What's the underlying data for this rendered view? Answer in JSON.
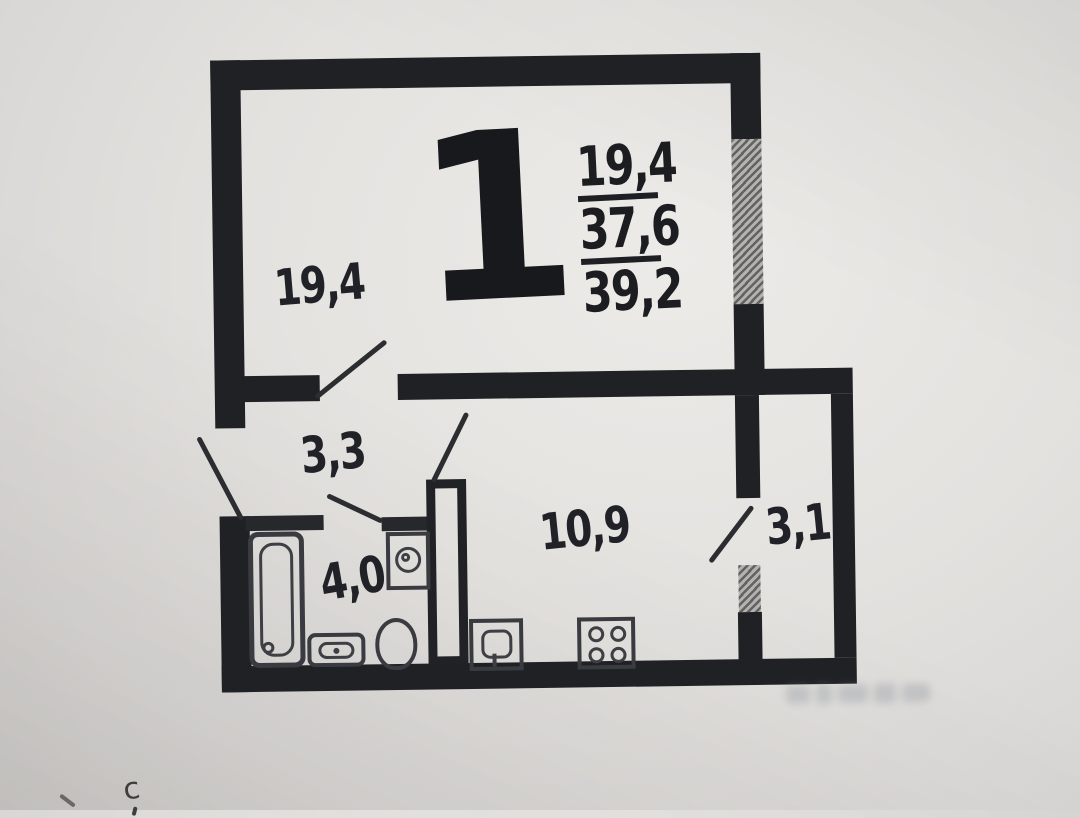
{
  "plan": {
    "unit": {
      "rooms_count": "1",
      "living_area": "19,4",
      "area_without_balcony": "37,6",
      "total_area": "39,2"
    },
    "room_labels": {
      "living": "19,4",
      "hallway": "3,3",
      "bathroom": "4,0",
      "kitchen": "10,9",
      "balcony": "3,1"
    },
    "compass": {
      "north_label": "с"
    },
    "fixture_icons": [
      "bathtub-icon",
      "washing-machine-icon",
      "toilet-icon",
      "sink-icon",
      "kitchen-sink-icon",
      "stove-icon"
    ],
    "colors": {
      "wall": "#1f2125",
      "hatch_gray": "#8f8e8c",
      "paper": "#e7e5e2"
    }
  }
}
